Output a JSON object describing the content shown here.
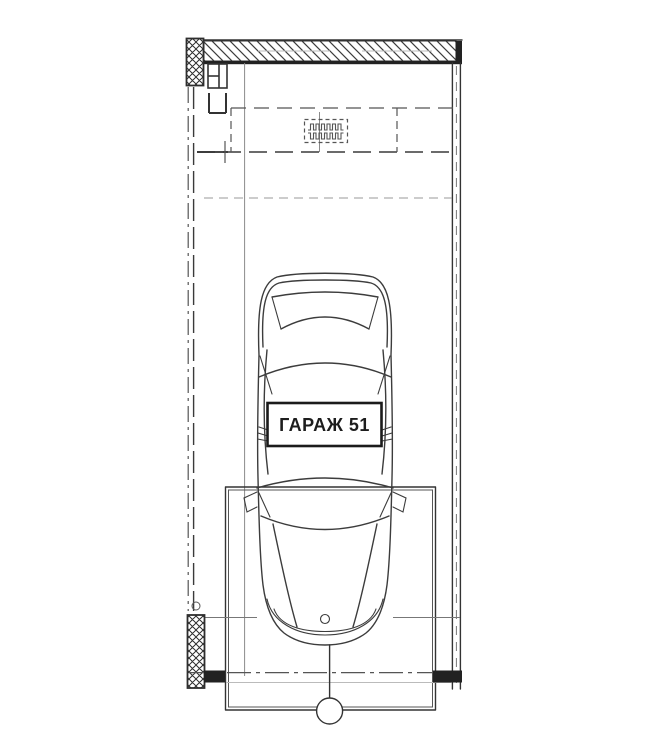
{
  "page": {
    "width": 650,
    "height": 750,
    "background": "#ffffff"
  },
  "drawing": {
    "type": "architectural-floor-plan",
    "label": {
      "text": "ГАРАЖ 51"
    },
    "axis_bubble_label": "",
    "colors": {
      "paper": "#ffffff",
      "ink": "#333333",
      "ink_mid": "#555555",
      "ink_light": "#8a8a8a",
      "ink_faint": "#bbbbbb",
      "hatch": "#3d3d3d",
      "label_border": "#1b1b1b",
      "label_text": "#1d1d1d"
    }
  }
}
